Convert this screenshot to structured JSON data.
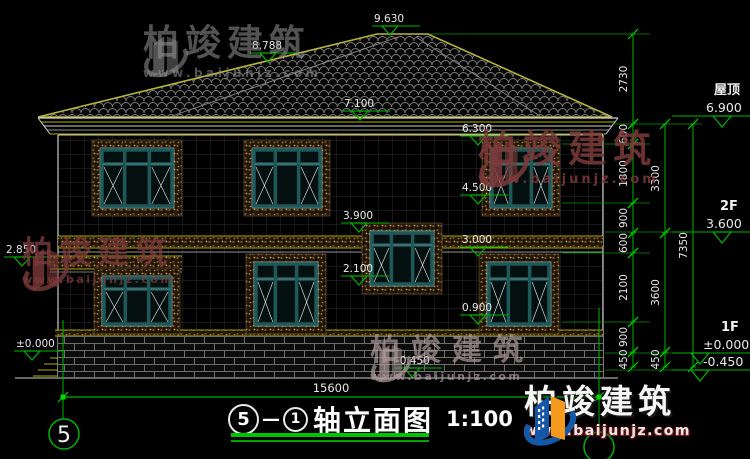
{
  "brand": {
    "name": "柏竣建筑",
    "site": "www.baijunjz.com"
  },
  "title": {
    "axis_left": "5",
    "separator": "—",
    "axis_right": "1",
    "text": "轴立面图",
    "scale": "1:100"
  },
  "drawing": {
    "green": "#00b400",
    "elevation_markers": [
      {
        "t": "9.630",
        "x": 372,
        "y": 35
      },
      {
        "t": "8.788",
        "x": 250,
        "y": 62
      },
      {
        "t": "7.100",
        "x": 342,
        "y": 120
      },
      {
        "t": "6.300",
        "x": 460,
        "y": 145
      },
      {
        "t": "4.500",
        "x": 460,
        "y": 204
      },
      {
        "t": "3.900",
        "x": 341,
        "y": 232
      },
      {
        "t": "3.000",
        "x": 460,
        "y": 256
      },
      {
        "t": "2.100",
        "x": 341,
        "y": 285
      },
      {
        "t": "0.900",
        "x": 460,
        "y": 324
      },
      {
        "t": "2.850",
        "x": 4,
        "y": 266
      },
      {
        "t": "±0.000",
        "x": 14,
        "y": 360
      },
      {
        "t": "-0.450",
        "x": 394,
        "y": 377
      }
    ],
    "right_levels": [
      {
        "label": "屋顶",
        "value": "6.900",
        "y": 116,
        "cx": 722,
        "lx": 714,
        "vx": 706
      },
      {
        "label": "2F",
        "value": "3.600",
        "y": 232,
        "cx": 722,
        "lx": 720,
        "vx": 706
      },
      {
        "label": "1F",
        "value": "±0.000",
        "y": 353,
        "cx": 700,
        "lx": 721,
        "vx": 703
      },
      {
        "label": "",
        "value": "-0.450",
        "y": 370,
        "cx": 700,
        "lx": 0,
        "vx": 703
      }
    ],
    "chains": [
      {
        "x": 633,
        "segs": [
          [
            "2730",
            34,
            124
          ],
          [
            "600",
            124,
            144
          ],
          [
            "1800",
            144,
            203
          ],
          [
            "900",
            203,
            233
          ],
          [
            "600",
            233,
            253
          ],
          [
            "2100",
            253,
            322
          ],
          [
            "900",
            322,
            352
          ],
          [
            "450",
            352,
            367
          ]
        ]
      },
      {
        "x": 665,
        "segs": [
          [
            "3300",
            124,
            233
          ],
          [
            "3600",
            233,
            352
          ],
          [
            "450",
            352,
            367
          ]
        ]
      },
      {
        "x": 693,
        "segs": [
          [
            "7350",
            124,
            367
          ]
        ]
      }
    ],
    "ext_lines": [
      [
        430,
        650,
        34
      ],
      [
        612,
        702,
        124
      ],
      [
        562,
        650,
        144
      ],
      [
        562,
        650,
        203
      ],
      [
        605,
        750,
        232
      ],
      [
        562,
        650,
        253
      ],
      [
        562,
        650,
        322
      ],
      [
        605,
        750,
        353
      ],
      [
        605,
        750,
        370
      ]
    ],
    "bottom_dim": {
      "label": "15600",
      "x1": 63,
      "x2": 599,
      "y": 397,
      "tx": 331
    },
    "axis_bubbles": [
      {
        "label": "5",
        "cx": 64,
        "cy": 434,
        "lx": 63,
        "ly1": 320,
        "ly2": 419
      },
      {
        "label": "",
        "cx": 599,
        "cy": 447,
        "lx": 599,
        "ly1": 308,
        "ly2": 432
      }
    ],
    "windows": [
      {
        "x": 92,
        "y": 140,
        "w": 90,
        "h": 76
      },
      {
        "x": 244,
        "y": 140,
        "w": 86,
        "h": 76
      },
      {
        "x": 482,
        "y": 140,
        "w": 78,
        "h": 76
      },
      {
        "x": 362,
        "y": 223,
        "w": 80,
        "h": 71
      },
      {
        "x": 94,
        "y": 268,
        "w": 86,
        "h": 66
      },
      {
        "x": 246,
        "y": 254,
        "w": 80,
        "h": 80
      },
      {
        "x": 479,
        "y": 254,
        "w": 80,
        "h": 80
      }
    ]
  }
}
